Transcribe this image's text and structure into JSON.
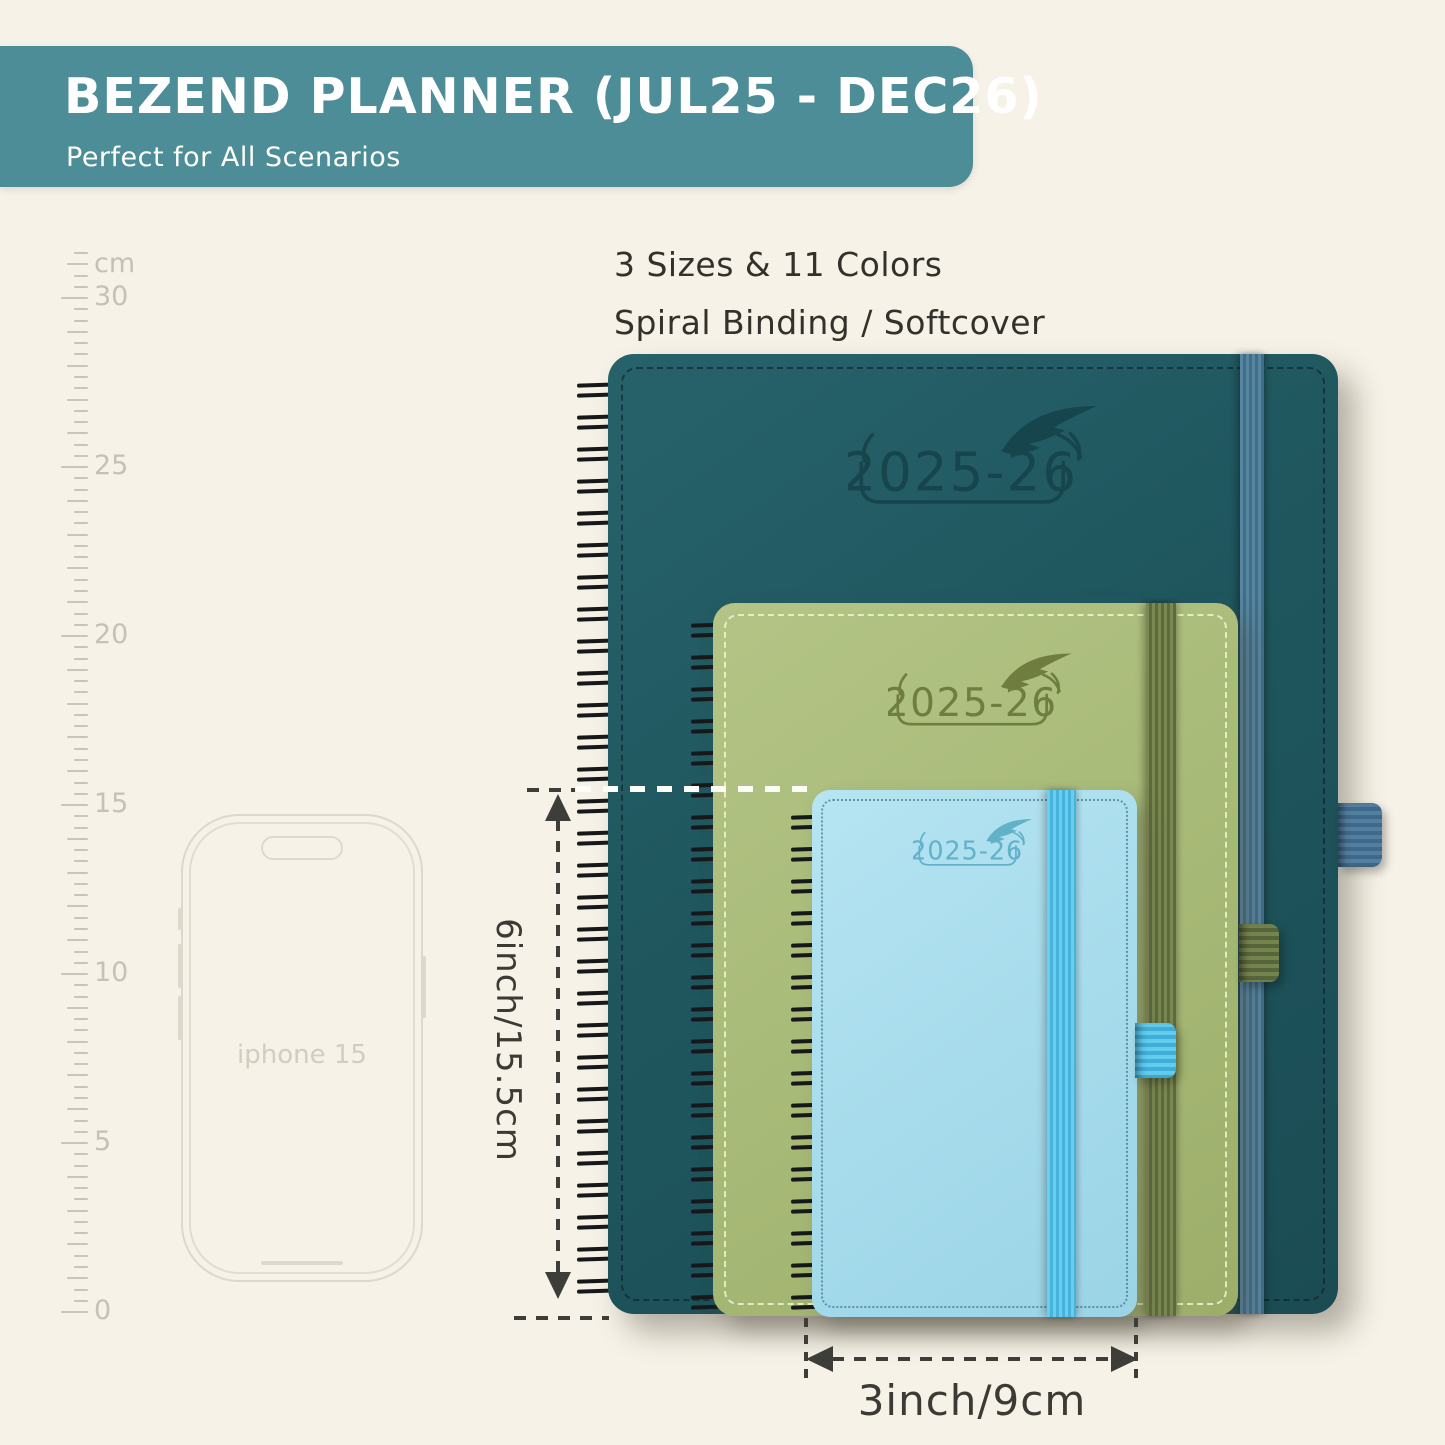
{
  "header": {
    "title": "BEZEND PLANNER (JUL25 - DEC26)",
    "subtitle": "Perfect for All Scenarios"
  },
  "intro": {
    "line1": "3 Sizes & 11 Colors",
    "line2": "Spiral Binding / Softcover"
  },
  "ruler": {
    "unit_label": "cm",
    "tick_labels": [
      "30",
      "25",
      "20",
      "15",
      "10",
      "5",
      "0"
    ]
  },
  "phone": {
    "label": "iphone 15"
  },
  "planners": {
    "large": {
      "year_label": "2025-26",
      "cover_color": "#1f565e",
      "band_color": "#4b7da0"
    },
    "medium": {
      "year_label": "2025-26",
      "cover_color": "#a8ba77",
      "band_color": "#6b7946"
    },
    "small": {
      "year_label": "2025-26",
      "cover_color": "#a7dcec",
      "band_color": "#55c3e6"
    }
  },
  "dimensions": {
    "height_label": "6inch/15.5cm",
    "width_label": "3inch/9cm"
  },
  "colors": {
    "background": "#f6f2e7",
    "banner": "#4d8d97",
    "annotation_text": "#3b3a35",
    "ruler": "#c9c5b9"
  }
}
